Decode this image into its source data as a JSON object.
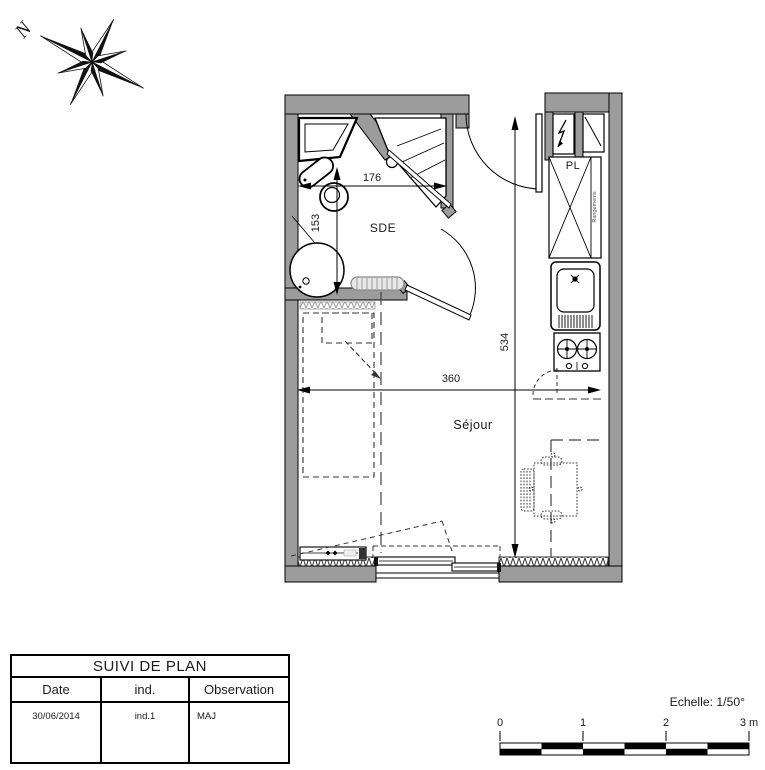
{
  "compass": {
    "north_label": "N"
  },
  "plan": {
    "rooms": {
      "bathroom": "SDE",
      "closet": "PL",
      "living": "Séjour"
    },
    "closet_annotation": "Rangements",
    "dimensions": {
      "bathroom_width": "176",
      "bathroom_depth": "153",
      "interior_depth": "534",
      "living_width": "360"
    }
  },
  "title_block": {
    "title": "SUIVI DE PLAN",
    "columns": [
      "Date",
      "ind.",
      "Observation"
    ],
    "row": {
      "date": "30/06/2014",
      "ind": "ind.1",
      "observation": "MAJ"
    }
  },
  "scale": {
    "label": "Echelle: 1/50°",
    "ticks": [
      "0",
      "1",
      "2",
      "3 m"
    ]
  },
  "colors": {
    "wall": "#9c9c9c",
    "line": "#1a1a1a",
    "background": "#ffffff"
  }
}
